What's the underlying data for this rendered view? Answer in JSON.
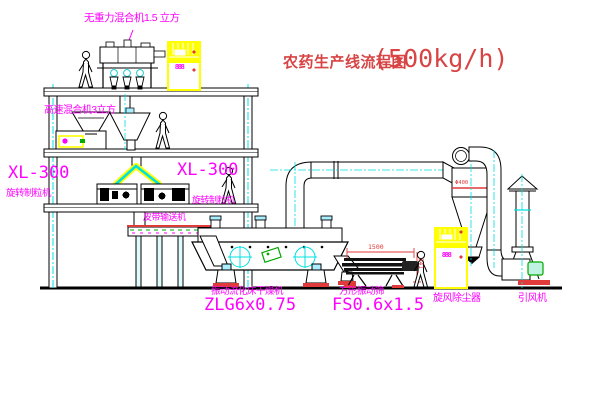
{
  "title": {
    "text": "农药生产线流程图",
    "capacity": "(500kg/h)"
  },
  "labels": {
    "mixer_top": "无重力混合机1.5 立方",
    "mixer_2f": "高速混合机3立方",
    "granulator_left_model": "XL-300",
    "granulator_left_name": "旋转制粒机",
    "granulator_mid_model": "XL-300",
    "granulator_mid_name": "旋转制粒机",
    "belt_conveyor": "皮带输送机",
    "dryer_name": "振动流化床干燥机",
    "dryer_model": "ZLG6x0.75",
    "sieve_name": "方形振动筛",
    "sieve_model": "FS0.6x1.5",
    "cyclone_label": "旋风除尘器",
    "fan_label": "引风机",
    "cabinet_display": "888"
  },
  "dimensions": {
    "sieve_length": "1500",
    "sieve_height": "541",
    "cyclone_diameter": "Φ400"
  },
  "colors": {
    "label_magenta": "#ff00ff",
    "title_red": "#d84444",
    "dimension_red": "#e03a3a",
    "pipe_cyan": "#00e0e0",
    "cabinet_yellow": "#ffff00",
    "accent_green": "#00aa00",
    "line_black": "#000000"
  }
}
